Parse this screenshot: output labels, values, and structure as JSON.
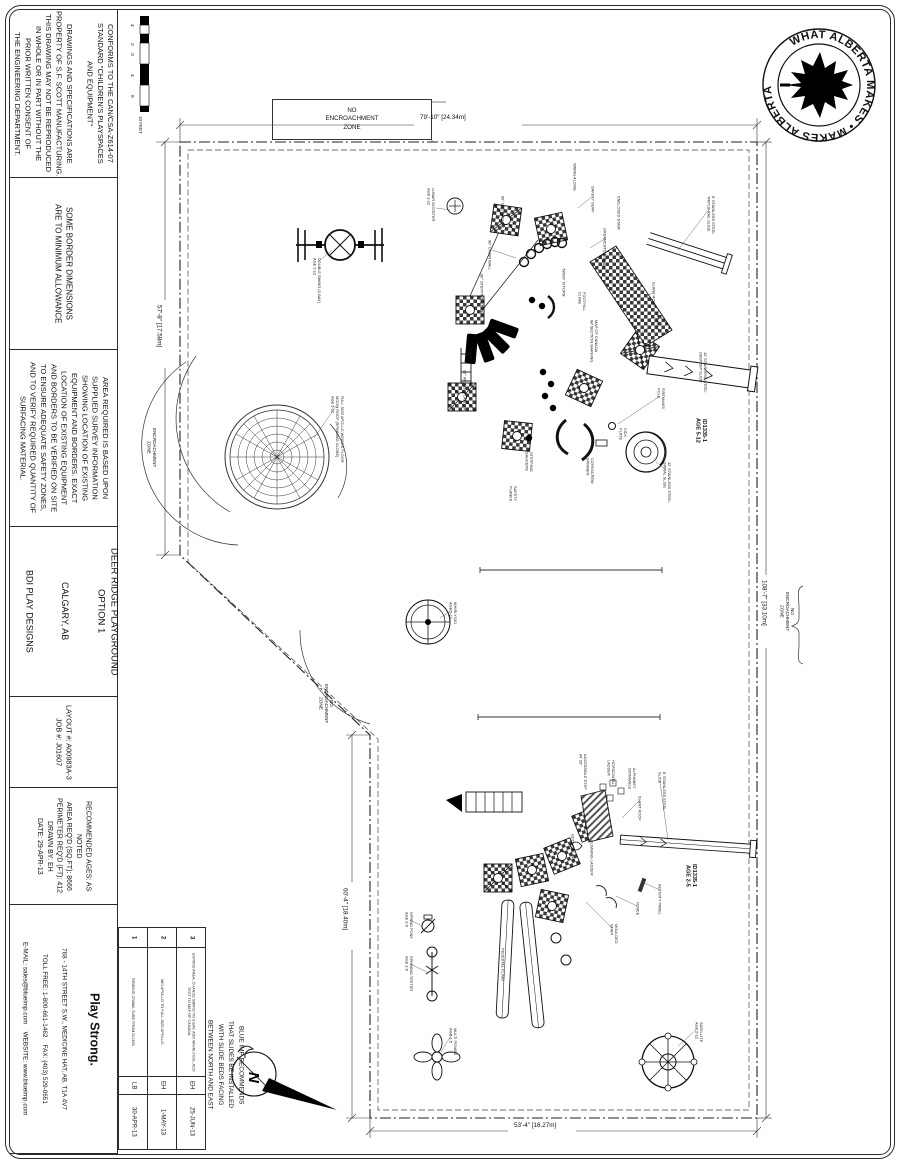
{
  "sheet": {
    "width": 900,
    "height": 1164
  },
  "sidebar": {
    "conformance": "CONFORMS TO THE CAN/CSA-Z614-07\nSTANDARD \"CHILDREN'S PLAYSPACES\nAND EQUIPMENT\"\n\nDRAWINGS AND SPECIFICATIONS ARE\nPROPERTY OF S.F. SCOTT MANUFACTURING.\nTHIS DRAWING MAY NOT BE REPRODUCED\nIN WHOLE OR IN PART WITHOUT THE\nPRIOR WRITTEN CONSENT OF\nTHE ENGINEERING DEPARTMENT.",
    "border_note": "SOME BORDER DIMENSIONS\nARE TO MINIMUM ALLOWANCE",
    "area_note": "AREA REQUIRED IS BASED UPON\nSUPPLIED SURVEY INFORMATION\nSHOWING LOCATION OF EXISTING\nEQUIPMENT AND BORDERS.  EXACT\nLOCATION OF EXISTING EQUIPMENT\nAND BORDERS TO BE VERIFIED ON SITE\nTO ENSURE ADEQUATE SAFETY ZONES,\nAND TO VERIFY REQUIRED QUANTITY OF\nSURFACING MATERIAL.",
    "project": {
      "title": "DEER RIDGE PLAYGROUND\nOPTION 1",
      "location": "CALGARY, AB",
      "client": "BDI PLAY DESIGNS"
    },
    "job": "LAYOUT #:   A00983A-3\nJOB #:        J01607",
    "specs": "RECOMMENDED AGES:    AS NOTED\nAREA REQ'D (SQ.FT):      8666\nPERIMETER REQ'D (FT):  412\nDRAWN BY:                    EH\nDATE:            29-APR-13"
  },
  "revisions": [
    {
      "num": "3",
      "note": "EXPAND AREA, CHANGE SWING TO 2-BAY, ADD WHIRLYGIG, ADD TEXT TO MAP OF CANADA.",
      "by": "EH",
      "date": "25-JUN-13"
    },
    {
      "num": "2",
      "note": "MID APOLLO TO FULL SIZE APOLLO.",
      "by": "EH",
      "date": "1-MAY-13"
    },
    {
      "num": "1",
      "note": "REMOVE CRAWL TUBE FROM ID1335",
      "by": "LB",
      "date": "30-APR-13"
    }
  ],
  "logo": {
    "brand_left": "BLUE",
    "brand_right": "IMP",
    "trademark": "™",
    "tagline": "Play Strong.",
    "address_line1": "768 - 14TH STREET S.W., MEDICINE HAT, AB, T1A 4V7",
    "address_line2": "TOLL FREE: 1-800-661-1462    FAX: (403) 529-0651",
    "address_line3": "E-MAIL: sales@blueimp.com    WEBSITE: www.blueimp.com"
  },
  "badge": {
    "ring_text": "WHAT ALBERTA MAKES • MAKES ALBERTA •"
  },
  "install_note": "BLUE IMP RECOMMENDS\nTHAT SLIDES BE INSTALLED\nWITH SLIDE BEDS FACING\nBETWEEN NORTH AND EAST",
  "compass": {
    "label": "N"
  },
  "scale": {
    "ticks": [
      "4",
      "2",
      "0",
      "4",
      "8"
    ],
    "unit": "10 FEET"
  },
  "drawing": {
    "zone_top": "NO\nENCROACHMENT\nZONE",
    "labels": [
      {
        "t": "79'-10\" [24.34m]",
        "x": 420,
        "y": 114,
        "v": false,
        "cls": "dim",
        "n": "dimension-top"
      },
      {
        "t": "53'-4\" [16.27m]",
        "x": 514,
        "y": 1122,
        "v": false,
        "cls": "dim",
        "n": "dimension-bottom"
      },
      {
        "t": "57'-8\" [17.58m]",
        "x": 155,
        "y": 305,
        "v": true,
        "cls": "dim",
        "n": "dimension-left-upper"
      },
      {
        "t": "60'-4\" [18.40m]",
        "x": 341,
        "y": 888,
        "v": true,
        "cls": "dim",
        "n": "dimension-left-lower"
      },
      {
        "t": "108'-7\" [33.10m]",
        "x": 760,
        "y": 580,
        "v": true,
        "cls": "dim",
        "n": "dimension-right"
      },
      {
        "t": "ENCROACHMENT\nZONE",
        "x": 146,
        "y": 428,
        "v": true,
        "cls": "zone",
        "n": "zone-label-left"
      },
      {
        "t": "NO\nENCROACHMENT\nZONE",
        "x": 318,
        "y": 684,
        "v": true,
        "cls": "zone",
        "n": "zone-label-diagonal"
      },
      {
        "t": "NO\nENCROACHMENT\nZONE",
        "x": 779,
        "y": 592,
        "v": true,
        "cls": "zone",
        "n": "zone-label-right"
      },
      {
        "t": "ID1335-1\nAGE 5-12",
        "x": 694,
        "y": 418,
        "v": true,
        "cls": "sid",
        "n": "structure-id-5-12"
      },
      {
        "t": "ID1335-1\nAGE 2-5",
        "x": 684,
        "y": 864,
        "v": true,
        "cls": "sid",
        "n": "structure-id-2-5"
      },
      {
        "t": "DOUBLE SWING (2-BAY)\nAGE 2-12",
        "x": 312,
        "y": 258,
        "v": true
      },
      {
        "t": "FULL SIZE APOLLO W/DECK FLOOR\nMOON ROOF (SPINNING GLOBE)\nAGE 5-12",
        "x": 330,
        "y": 396,
        "v": true
      },
      {
        "t": "LUNAR BOOSTER\nAGE 2-12",
        "x": 426,
        "y": 188,
        "v": true
      },
      {
        "t": "90° CROSSOVER",
        "x": 500,
        "y": 196,
        "v": true
      },
      {
        "t": "90° CHAIN WALL",
        "x": 487,
        "y": 240,
        "v": true
      },
      {
        "t": "SWING ALONG",
        "x": 572,
        "y": 163,
        "v": true
      },
      {
        "t": "SAFETY SURF",
        "x": 590,
        "y": 186,
        "v": true
      },
      {
        "t": "DREAMCATCHER",
        "x": 602,
        "y": 228,
        "v": true
      },
      {
        "t": "ENCLOSED STAIR",
        "x": 616,
        "y": 196,
        "v": true
      },
      {
        "t": "8' STAINLESS STEEL\nTRIPLE RAIL SLIDE",
        "x": 706,
        "y": 196,
        "v": true
      },
      {
        "t": "STAIR",
        "x": 601,
        "y": 258,
        "v": true
      },
      {
        "t": "SLANT ROOF",
        "x": 651,
        "y": 282,
        "v": true
      },
      {
        "t": "CATWALK",
        "x": 655,
        "y": 312,
        "v": true
      },
      {
        "t": "12' STAINLESS STEEL\nDEEP DIP SLIDE",
        "x": 698,
        "y": 352,
        "v": true
      },
      {
        "t": "FIREMAN'S\nPOLE",
        "x": 656,
        "y": 388,
        "v": true
      },
      {
        "t": "KICK\nPLATE",
        "x": 618,
        "y": 428,
        "v": true
      },
      {
        "t": "12' STAINLESS STEEL\nSPIRAL SLIDE",
        "x": 662,
        "y": 462,
        "v": true
      },
      {
        "t": "90° STEPPING STONES",
        "x": 479,
        "y": 274,
        "v": true
      },
      {
        "t": "TWIST 'N TURN",
        "x": 561,
        "y": 268,
        "v": true
      },
      {
        "t": "FOOTHILL\nCLIMB",
        "x": 577,
        "y": 292,
        "v": true
      },
      {
        "t": "MAP OF CANADA\nW/ SECTION MARKING",
        "x": 589,
        "y": 320,
        "v": true
      },
      {
        "t": "90° WOBBLE LADDER",
        "x": 462,
        "y": 370,
        "v": true
      },
      {
        "t": "STEPPING\nSAUCERS",
        "x": 524,
        "y": 452,
        "v": true
      },
      {
        "t": "CORKSCREW\nSPINNER",
        "x": 585,
        "y": 458,
        "v": true
      },
      {
        "t": "SAFETY\nPLANKS",
        "x": 508,
        "y": 486,
        "v": true
      },
      {
        "t": "WHIRLYGIG\nAGE 5-12",
        "x": 448,
        "y": 602,
        "v": true
      },
      {
        "t": "ACCESSIBLE STEP\nAT 16\"",
        "x": 578,
        "y": 754,
        "v": true
      },
      {
        "t": "HORIZONTAL\nLADDER",
        "x": 606,
        "y": 760,
        "v": true
      },
      {
        "t": "ALPHABET\nSCRAMBLE",
        "x": 627,
        "y": 768,
        "v": true
      },
      {
        "t": "SLANT ROOF",
        "x": 637,
        "y": 796,
        "v": true
      },
      {
        "t": "6' STAINLESS STEEL\nSLIDE",
        "x": 657,
        "y": 772,
        "v": true
      },
      {
        "t": "ACTIVITY PANEL",
        "x": 657,
        "y": 884,
        "v": true
      },
      {
        "t": "FENCE",
        "x": 635,
        "y": 902,
        "v": true
      },
      {
        "t": "MOULDED\nSTAIR",
        "x": 609,
        "y": 924,
        "v": true
      },
      {
        "t": "GECKO CLIMB",
        "x": 570,
        "y": 834,
        "v": true
      },
      {
        "t": "CLIMBING LADDER",
        "x": 589,
        "y": 840,
        "v": true
      },
      {
        "t": "PEDESTAL CLIMB",
        "x": 500,
        "y": 948,
        "v": true
      },
      {
        "t": "SPRING PONY\nAGE 2-5",
        "x": 404,
        "y": 912,
        "v": true
      },
      {
        "t": "SPINNING TEETER\nAGE 2-5",
        "x": 404,
        "y": 956,
        "v": true
      },
      {
        "t": "MULTI PONIES\nAGE 2-5",
        "x": 448,
        "y": 1028,
        "v": true
      },
      {
        "t": "SATELLITE\nAGE 5-12",
        "x": 694,
        "y": 1022,
        "v": true
      }
    ]
  }
}
